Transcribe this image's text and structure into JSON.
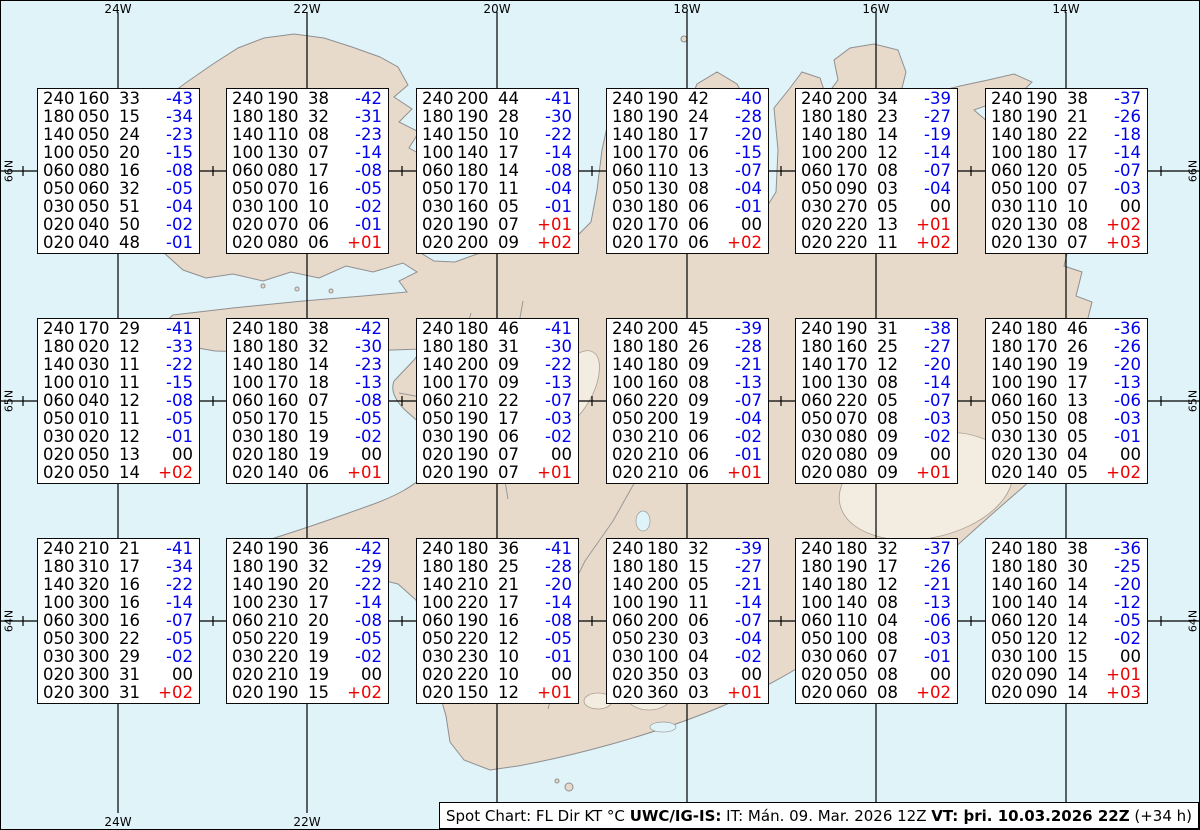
{
  "colors": {
    "sea": "#e0f3f9",
    "land": "#e8dacb",
    "coast": "#8f8f8f",
    "grid": "#000000",
    "negative_temp": "#0000ee",
    "positive_temp": "#ee0000"
  },
  "grid": {
    "vlines_x": [
      117,
      306,
      496,
      686,
      875,
      1065
    ],
    "hlines_y": [
      170,
      400,
      620
    ],
    "minor_x": [
      22,
      212,
      401,
      591,
      780,
      970,
      1160
    ],
    "v_top": 11,
    "v_bottom": 812
  },
  "axes": {
    "top": [
      "24W",
      "22W",
      "20W",
      "18W",
      "16W",
      "14W"
    ],
    "bottom": [
      "24W",
      "22W"
    ],
    "left": [
      "66N",
      "65N",
      "64N"
    ],
    "right": [
      "66N",
      "65N",
      "64N"
    ]
  },
  "chart_data": {
    "type": "table",
    "columns": [
      "FL",
      "Dir",
      "KT",
      "°C"
    ],
    "stations": [
      {
        "lat": "66N",
        "lon": "24W",
        "rows": [
          [
            "240",
            "160",
            "33",
            "-43"
          ],
          [
            "180",
            "050",
            "15",
            "-34"
          ],
          [
            "140",
            "050",
            "24",
            "-23"
          ],
          [
            "100",
            "050",
            "20",
            "-15"
          ],
          [
            "060",
            "080",
            "16",
            "-08"
          ],
          [
            "050",
            "060",
            "32",
            "-05"
          ],
          [
            "030",
            "050",
            "51",
            "-04"
          ],
          [
            "020",
            "040",
            "50",
            "-02"
          ],
          [
            "020",
            "040",
            "48",
            "-01"
          ]
        ]
      },
      {
        "lat": "66N",
        "lon": "22W",
        "rows": [
          [
            "240",
            "190",
            "38",
            "-42"
          ],
          [
            "180",
            "180",
            "32",
            "-31"
          ],
          [
            "140",
            "110",
            "08",
            "-23"
          ],
          [
            "100",
            "130",
            "07",
            "-14"
          ],
          [
            "060",
            "080",
            "17",
            "-08"
          ],
          [
            "050",
            "070",
            "16",
            "-05"
          ],
          [
            "030",
            "100",
            "10",
            "-02"
          ],
          [
            "020",
            "070",
            "06",
            "-01"
          ],
          [
            "020",
            "080",
            "06",
            "+01"
          ]
        ]
      },
      {
        "lat": "66N",
        "lon": "20W",
        "rows": [
          [
            "240",
            "200",
            "44",
            "-41"
          ],
          [
            "180",
            "190",
            "28",
            "-30"
          ],
          [
            "140",
            "150",
            "10",
            "-22"
          ],
          [
            "100",
            "140",
            "17",
            "-14"
          ],
          [
            "060",
            "180",
            "14",
            "-08"
          ],
          [
            "050",
            "170",
            "11",
            "-04"
          ],
          [
            "030",
            "160",
            "05",
            "-01"
          ],
          [
            "020",
            "190",
            "07",
            "+01"
          ],
          [
            "020",
            "200",
            "09",
            "+02"
          ]
        ]
      },
      {
        "lat": "66N",
        "lon": "18W",
        "rows": [
          [
            "240",
            "190",
            "42",
            "-40"
          ],
          [
            "180",
            "190",
            "24",
            "-28"
          ],
          [
            "140",
            "180",
            "17",
            "-20"
          ],
          [
            "100",
            "170",
            "06",
            "-15"
          ],
          [
            "060",
            "110",
            "13",
            "-07"
          ],
          [
            "050",
            "130",
            "08",
            "-04"
          ],
          [
            "030",
            "180",
            "06",
            "-01"
          ],
          [
            "020",
            "170",
            "06",
            "00"
          ],
          [
            "020",
            "170",
            "06",
            "+02"
          ]
        ]
      },
      {
        "lat": "66N",
        "lon": "16W",
        "rows": [
          [
            "240",
            "200",
            "34",
            "-39"
          ],
          [
            "180",
            "180",
            "23",
            "-27"
          ],
          [
            "140",
            "180",
            "14",
            "-19"
          ],
          [
            "100",
            "200",
            "12",
            "-14"
          ],
          [
            "060",
            "170",
            "08",
            "-07"
          ],
          [
            "050",
            "090",
            "03",
            "-04"
          ],
          [
            "030",
            "270",
            "05",
            "00"
          ],
          [
            "020",
            "220",
            "13",
            "+01"
          ],
          [
            "020",
            "220",
            "11",
            "+02"
          ]
        ]
      },
      {
        "lat": "66N",
        "lon": "14W",
        "rows": [
          [
            "240",
            "190",
            "38",
            "-37"
          ],
          [
            "180",
            "190",
            "21",
            "-26"
          ],
          [
            "140",
            "180",
            "22",
            "-18"
          ],
          [
            "100",
            "180",
            "17",
            "-14"
          ],
          [
            "060",
            "120",
            "05",
            "-07"
          ],
          [
            "050",
            "100",
            "07",
            "-03"
          ],
          [
            "030",
            "110",
            "10",
            "00"
          ],
          [
            "020",
            "130",
            "08",
            "+02"
          ],
          [
            "020",
            "130",
            "07",
            "+03"
          ]
        ]
      },
      {
        "lat": "65N",
        "lon": "24W",
        "rows": [
          [
            "240",
            "170",
            "29",
            "-41"
          ],
          [
            "180",
            "020",
            "12",
            "-33"
          ],
          [
            "140",
            "030",
            "11",
            "-22"
          ],
          [
            "100",
            "010",
            "11",
            "-15"
          ],
          [
            "060",
            "040",
            "12",
            "-08"
          ],
          [
            "050",
            "010",
            "11",
            "-05"
          ],
          [
            "030",
            "020",
            "12",
            "-01"
          ],
          [
            "020",
            "050",
            "13",
            "00"
          ],
          [
            "020",
            "050",
            "14",
            "+02"
          ]
        ]
      },
      {
        "lat": "65N",
        "lon": "22W",
        "rows": [
          [
            "240",
            "180",
            "38",
            "-42"
          ],
          [
            "180",
            "180",
            "32",
            "-30"
          ],
          [
            "140",
            "180",
            "14",
            "-23"
          ],
          [
            "100",
            "170",
            "18",
            "-13"
          ],
          [
            "060",
            "160",
            "07",
            "-08"
          ],
          [
            "050",
            "170",
            "15",
            "-05"
          ],
          [
            "030",
            "180",
            "19",
            "-02"
          ],
          [
            "020",
            "180",
            "19",
            "00"
          ],
          [
            "020",
            "140",
            "06",
            "+01"
          ]
        ]
      },
      {
        "lat": "65N",
        "lon": "20W",
        "rows": [
          [
            "240",
            "180",
            "46",
            "-41"
          ],
          [
            "180",
            "180",
            "31",
            "-30"
          ],
          [
            "140",
            "200",
            "09",
            "-22"
          ],
          [
            "100",
            "170",
            "09",
            "-13"
          ],
          [
            "060",
            "210",
            "22",
            "-07"
          ],
          [
            "050",
            "190",
            "17",
            "-03"
          ],
          [
            "030",
            "190",
            "06",
            "-02"
          ],
          [
            "020",
            "190",
            "07",
            "00"
          ],
          [
            "020",
            "190",
            "07",
            "+01"
          ]
        ]
      },
      {
        "lat": "65N",
        "lon": "18W",
        "rows": [
          [
            "240",
            "200",
            "45",
            "-39"
          ],
          [
            "180",
            "180",
            "26",
            "-28"
          ],
          [
            "140",
            "180",
            "09",
            "-21"
          ],
          [
            "100",
            "160",
            "08",
            "-13"
          ],
          [
            "060",
            "220",
            "09",
            "-07"
          ],
          [
            "050",
            "200",
            "19",
            "-04"
          ],
          [
            "030",
            "210",
            "06",
            "-02"
          ],
          [
            "020",
            "210",
            "06",
            "-01"
          ],
          [
            "020",
            "210",
            "06",
            "+01"
          ]
        ]
      },
      {
        "lat": "65N",
        "lon": "16W",
        "rows": [
          [
            "240",
            "190",
            "31",
            "-38"
          ],
          [
            "180",
            "160",
            "25",
            "-27"
          ],
          [
            "140",
            "170",
            "12",
            "-20"
          ],
          [
            "100",
            "130",
            "08",
            "-14"
          ],
          [
            "060",
            "220",
            "05",
            "-07"
          ],
          [
            "050",
            "070",
            "08",
            "-03"
          ],
          [
            "030",
            "080",
            "09",
            "-02"
          ],
          [
            "020",
            "080",
            "09",
            "00"
          ],
          [
            "020",
            "080",
            "09",
            "+01"
          ]
        ]
      },
      {
        "lat": "65N",
        "lon": "14W",
        "rows": [
          [
            "240",
            "180",
            "46",
            "-36"
          ],
          [
            "180",
            "170",
            "26",
            "-26"
          ],
          [
            "140",
            "190",
            "19",
            "-20"
          ],
          [
            "100",
            "190",
            "17",
            "-13"
          ],
          [
            "060",
            "160",
            "13",
            "-06"
          ],
          [
            "050",
            "150",
            "08",
            "-03"
          ],
          [
            "030",
            "130",
            "05",
            "-01"
          ],
          [
            "020",
            "130",
            "04",
            "00"
          ],
          [
            "020",
            "140",
            "05",
            "+02"
          ]
        ]
      },
      {
        "lat": "64N",
        "lon": "24W",
        "rows": [
          [
            "240",
            "210",
            "21",
            "-41"
          ],
          [
            "180",
            "310",
            "17",
            "-34"
          ],
          [
            "140",
            "320",
            "16",
            "-22"
          ],
          [
            "100",
            "300",
            "16",
            "-14"
          ],
          [
            "060",
            "300",
            "16",
            "-07"
          ],
          [
            "050",
            "300",
            "22",
            "-05"
          ],
          [
            "030",
            "300",
            "29",
            "-02"
          ],
          [
            "020",
            "300",
            "31",
            "00"
          ],
          [
            "020",
            "300",
            "31",
            "+02"
          ]
        ]
      },
      {
        "lat": "64N",
        "lon": "22W",
        "rows": [
          [
            "240",
            "190",
            "36",
            "-42"
          ],
          [
            "180",
            "190",
            "32",
            "-29"
          ],
          [
            "140",
            "190",
            "20",
            "-22"
          ],
          [
            "100",
            "230",
            "17",
            "-14"
          ],
          [
            "060",
            "210",
            "20",
            "-08"
          ],
          [
            "050",
            "220",
            "19",
            "-05"
          ],
          [
            "030",
            "220",
            "19",
            "-02"
          ],
          [
            "020",
            "210",
            "19",
            "00"
          ],
          [
            "020",
            "190",
            "15",
            "+02"
          ]
        ]
      },
      {
        "lat": "64N",
        "lon": "20W",
        "rows": [
          [
            "240",
            "180",
            "36",
            "-41"
          ],
          [
            "180",
            "180",
            "25",
            "-28"
          ],
          [
            "140",
            "210",
            "21",
            "-20"
          ],
          [
            "100",
            "220",
            "17",
            "-14"
          ],
          [
            "060",
            "190",
            "16",
            "-08"
          ],
          [
            "050",
            "220",
            "12",
            "-05"
          ],
          [
            "030",
            "230",
            "10",
            "-01"
          ],
          [
            "020",
            "220",
            "10",
            "00"
          ],
          [
            "020",
            "150",
            "12",
            "+01"
          ]
        ]
      },
      {
        "lat": "64N",
        "lon": "18W",
        "rows": [
          [
            "240",
            "180",
            "32",
            "-39"
          ],
          [
            "180",
            "180",
            "15",
            "-27"
          ],
          [
            "140",
            "200",
            "05",
            "-21"
          ],
          [
            "100",
            "190",
            "11",
            "-14"
          ],
          [
            "060",
            "200",
            "06",
            "-07"
          ],
          [
            "050",
            "230",
            "03",
            "-04"
          ],
          [
            "030",
            "100",
            "04",
            "-02"
          ],
          [
            "020",
            "350",
            "03",
            "00"
          ],
          [
            "020",
            "360",
            "03",
            "+01"
          ]
        ]
      },
      {
        "lat": "64N",
        "lon": "16W",
        "rows": [
          [
            "240",
            "180",
            "32",
            "-37"
          ],
          [
            "180",
            "190",
            "17",
            "-26"
          ],
          [
            "140",
            "180",
            "12",
            "-21"
          ],
          [
            "100",
            "140",
            "08",
            "-13"
          ],
          [
            "060",
            "110",
            "04",
            "-06"
          ],
          [
            "050",
            "100",
            "08",
            "-03"
          ],
          [
            "030",
            "060",
            "07",
            "-01"
          ],
          [
            "020",
            "050",
            "08",
            "00"
          ],
          [
            "020",
            "060",
            "08",
            "+02"
          ]
        ]
      },
      {
        "lat": "64N",
        "lon": "14W",
        "rows": [
          [
            "240",
            "180",
            "38",
            "-36"
          ],
          [
            "180",
            "180",
            "30",
            "-25"
          ],
          [
            "140",
            "160",
            "14",
            "-20"
          ],
          [
            "100",
            "140",
            "14",
            "-12"
          ],
          [
            "060",
            "120",
            "14",
            "-05"
          ],
          [
            "050",
            "120",
            "12",
            "-02"
          ],
          [
            "030",
            "100",
            "15",
            "00"
          ],
          [
            "020",
            "090",
            "14",
            "+01"
          ],
          [
            "020",
            "090",
            "14",
            "+03"
          ]
        ]
      }
    ]
  },
  "caption": {
    "prefix": "Spot Chart: FL Dir KT °C ",
    "product_bold": "UWC/IG-IS:",
    "issued": " IT: Mán. 09. Mar. 2026 12Z ",
    "valid_bold": "VT: þri. 10.03.2026 22Z",
    "suffix": " (+34 h)"
  }
}
